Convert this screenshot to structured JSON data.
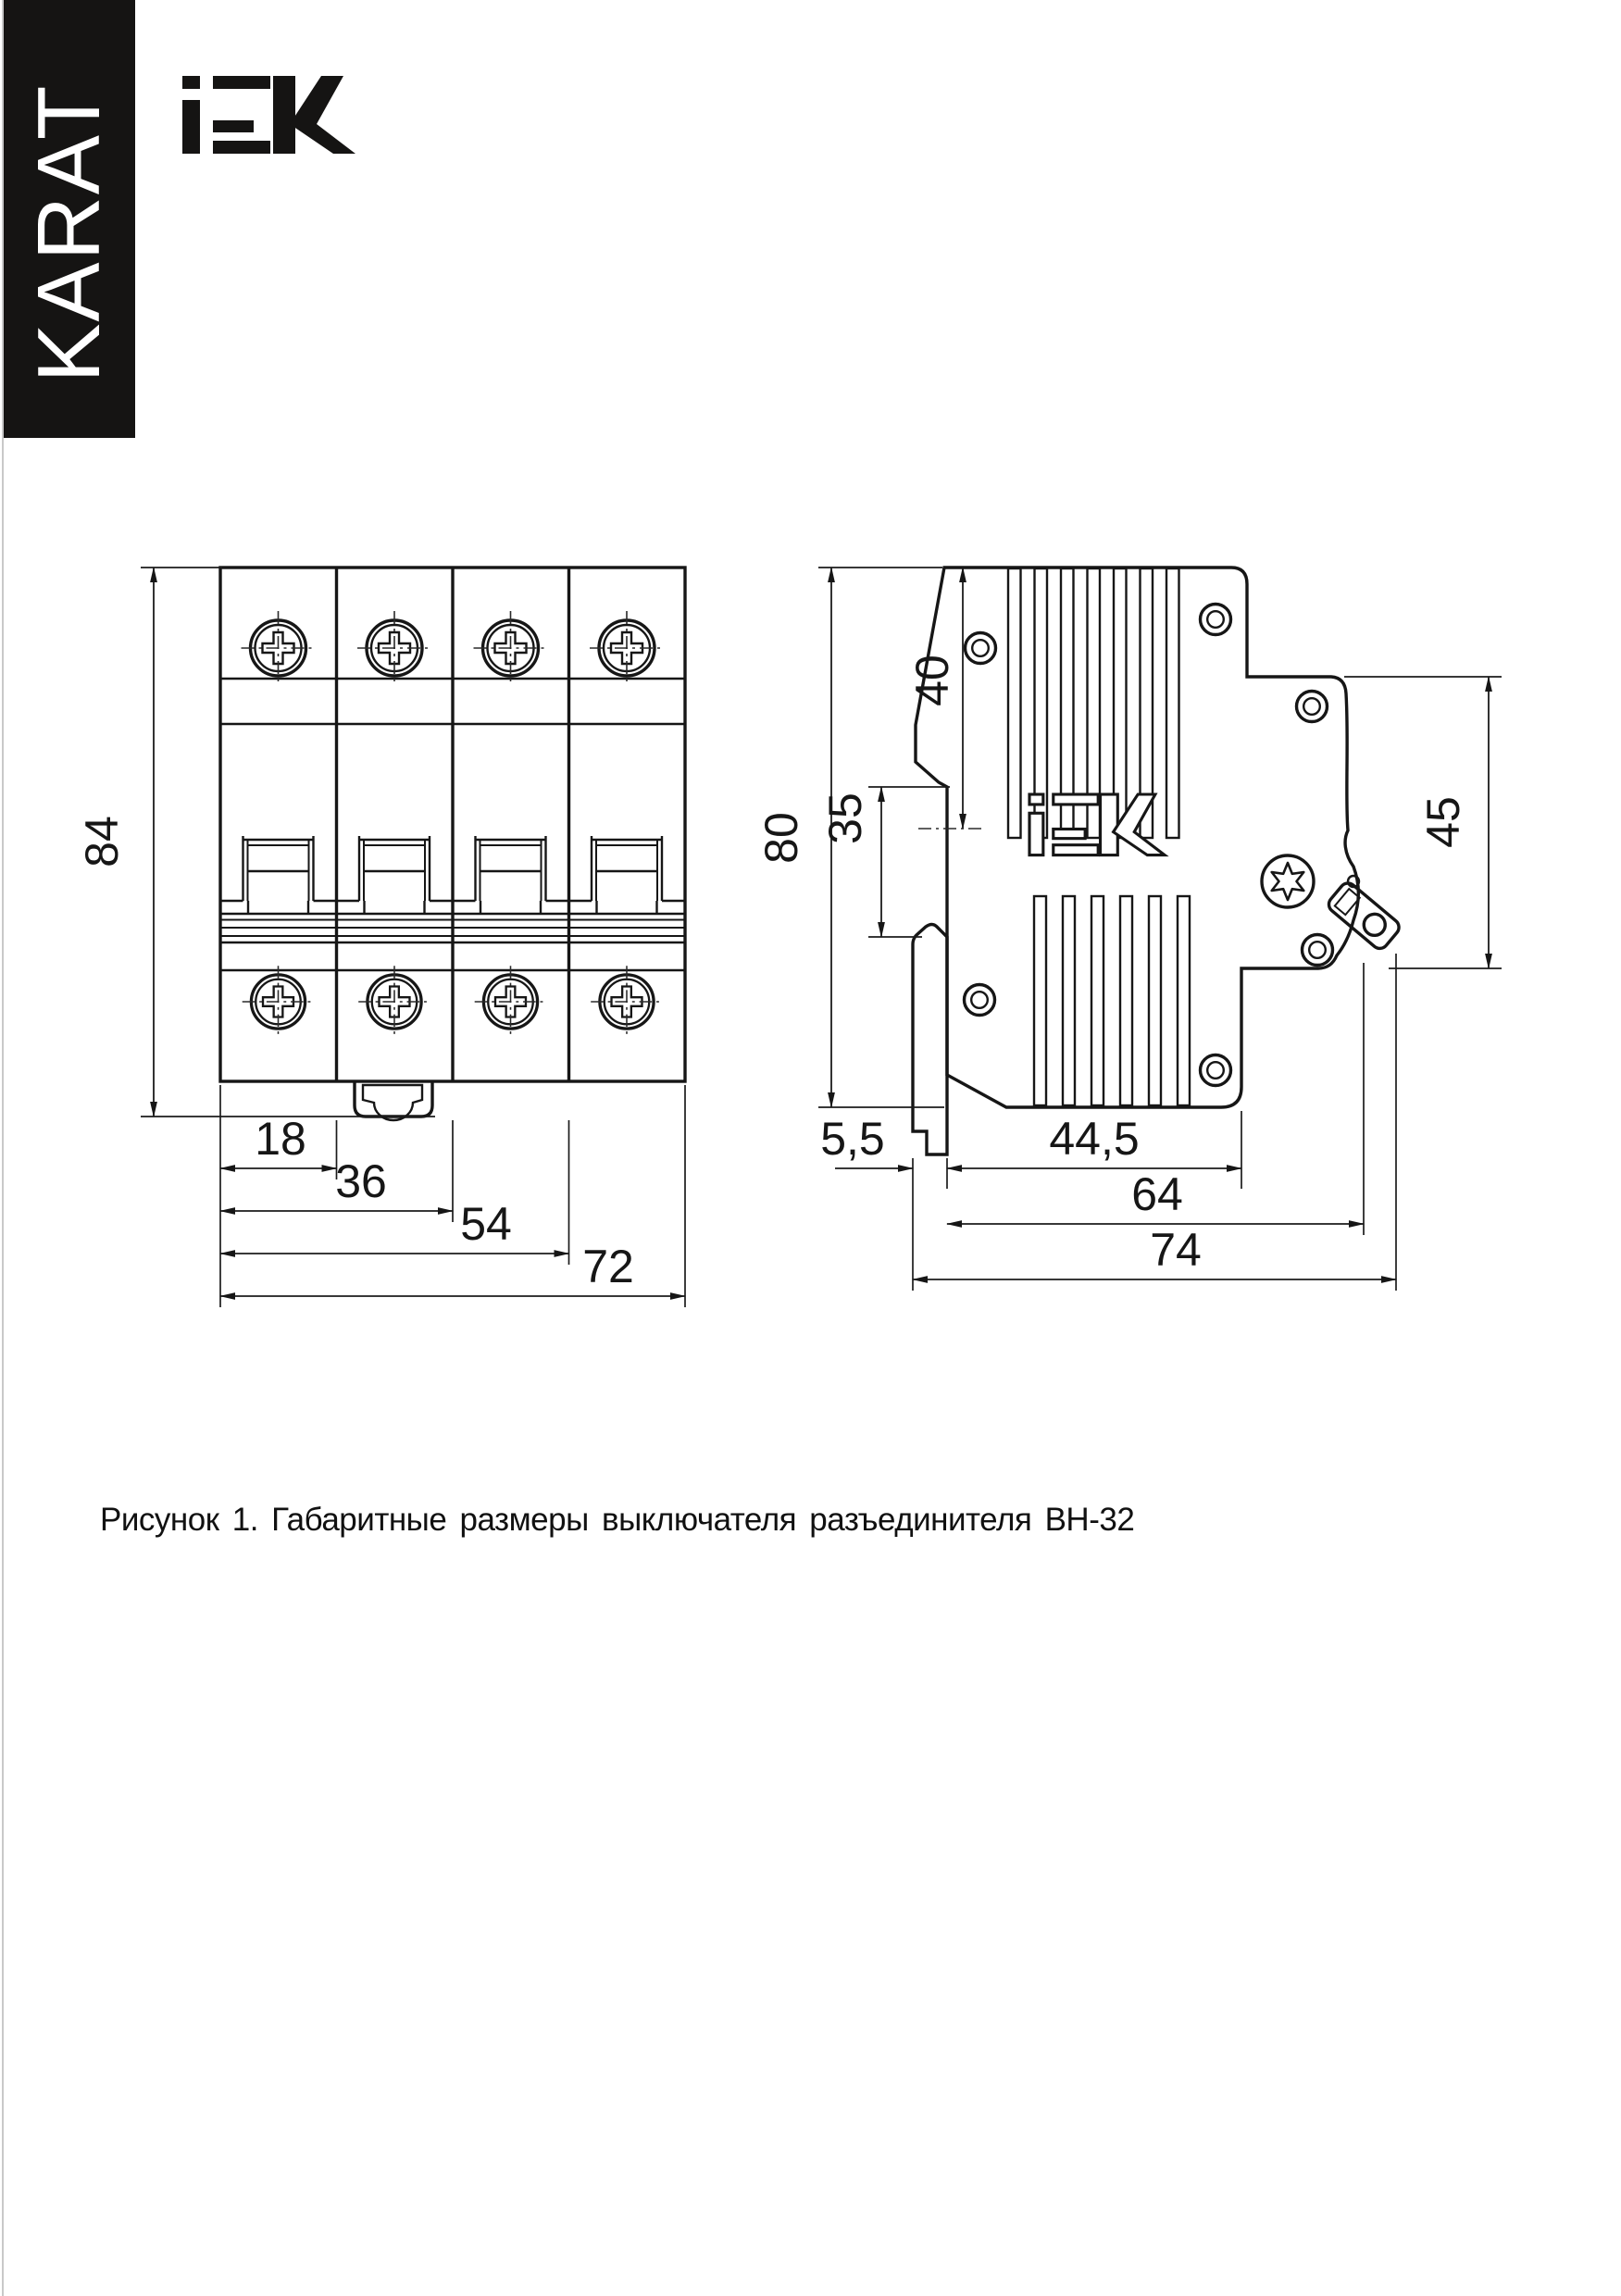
{
  "branding": {
    "karat": "KARAT",
    "iek_alt": "IEK"
  },
  "caption": "Рисунок 1. Габаритные размеры выключателя разъединителя ВН-32",
  "front_view": {
    "dim_height": "84",
    "dim_w1": "18",
    "dim_w2": "36",
    "dim_w3": "54",
    "dim_w4": "72"
  },
  "side_view": {
    "dim_height": "80",
    "dim_top_to_rail": "40",
    "dim_rail_recess": "35",
    "dim_front_section": "45",
    "dim_latch": "5,5",
    "dim_body_depth": "44,5",
    "dim_with_terminal": "64",
    "dim_total_depth": "74"
  }
}
